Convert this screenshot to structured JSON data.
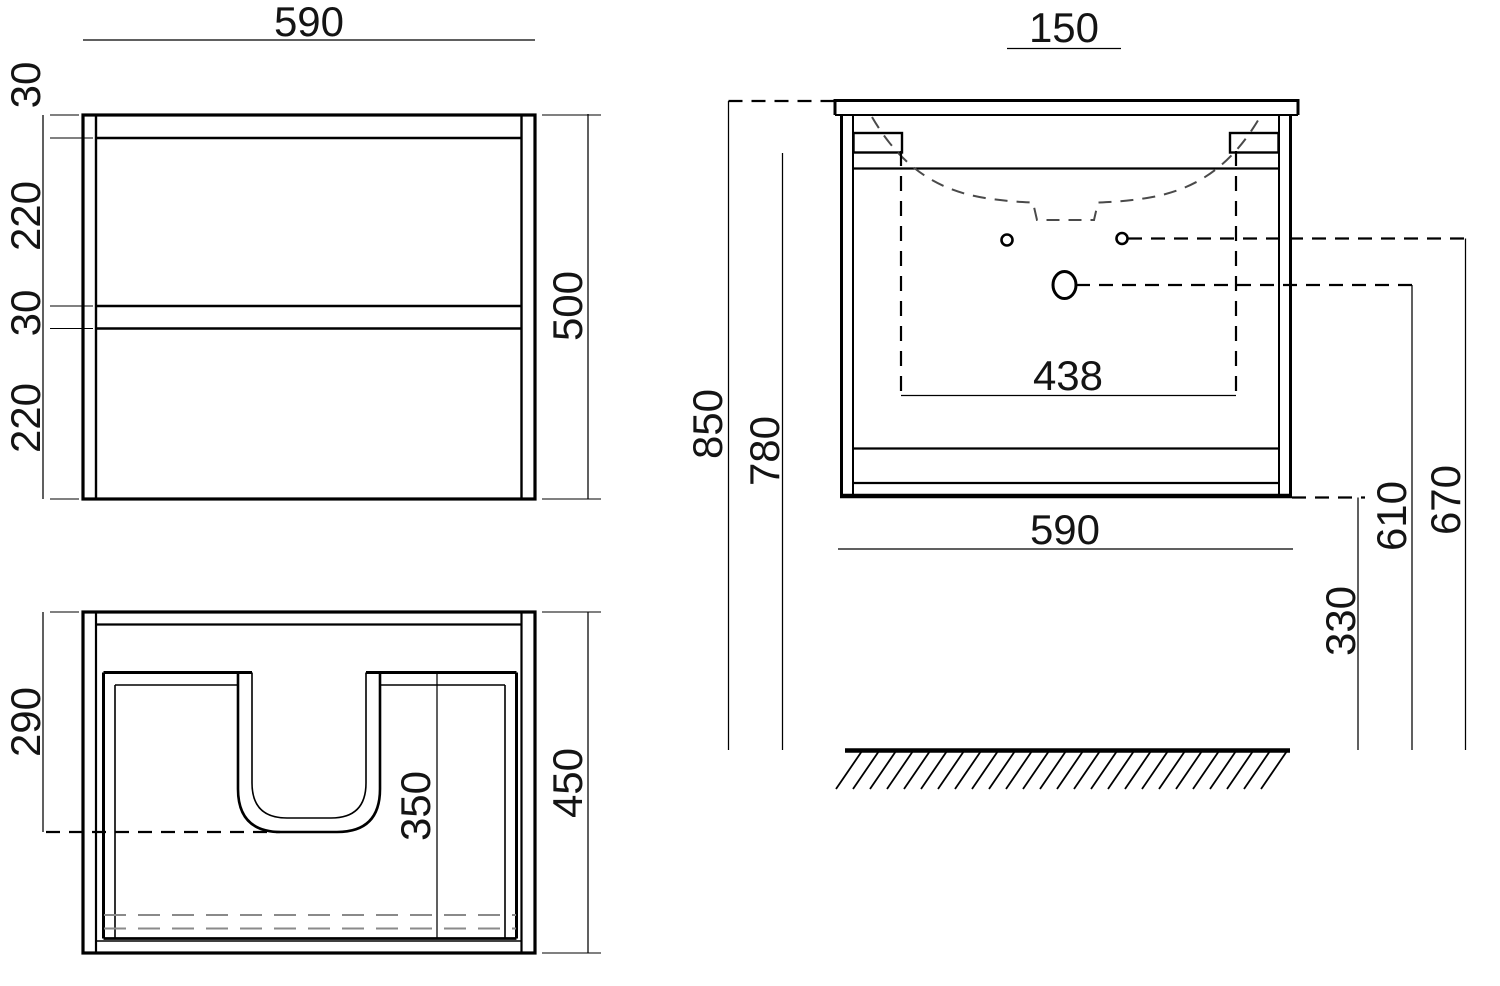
{
  "drawing": {
    "type": "vanity-cabinet-technical-drawing",
    "units": "mm",
    "colors": {
      "background": "#ffffff",
      "line": "#000000",
      "hidden_line": "#8a8a8a",
      "basin_hidden_line": "#4a4a4a"
    }
  },
  "front": {
    "width": "590",
    "top_rail": "30",
    "upper_drawer": "220",
    "middle_gap": "30",
    "lower_drawer": "220",
    "height": "500"
  },
  "plan": {
    "siphon_depth": "290",
    "cutout_depth": "350",
    "depth": "450"
  },
  "side": {
    "hole_spacing": "150",
    "overall_height": "850",
    "bracket_height": "780",
    "bracket_span": "438",
    "width": "590",
    "faucet_hole_height": "610",
    "fixing_hole_height": "670",
    "floor_clearance": "330"
  }
}
